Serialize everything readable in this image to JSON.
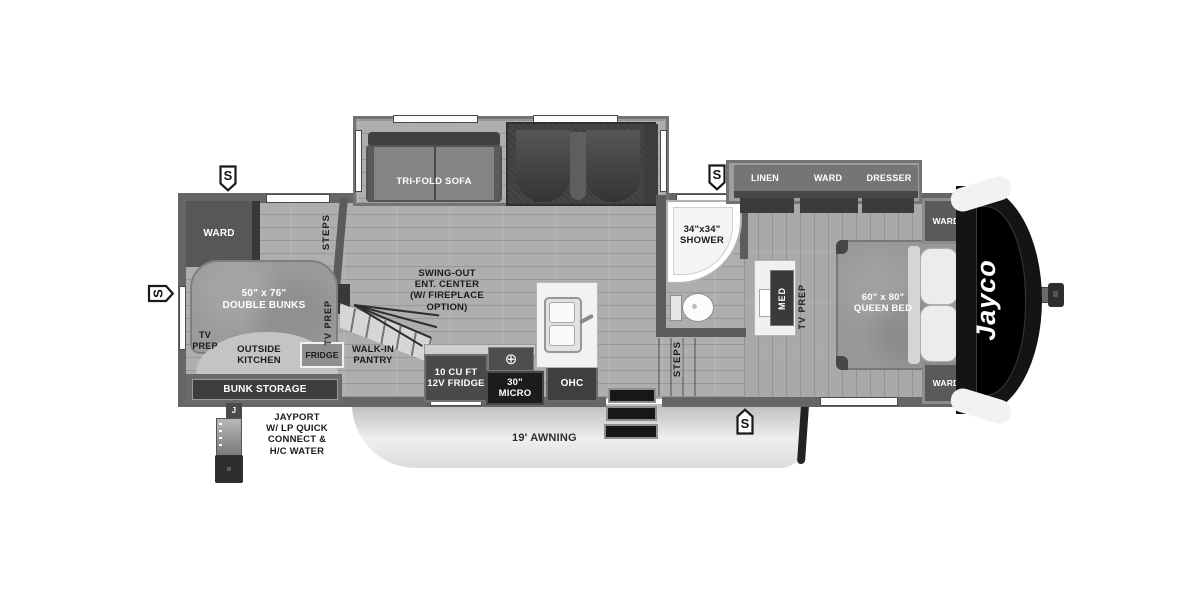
{
  "icons": {
    "speaker": "S",
    "burner": "⊕",
    "jayport_tab": "J"
  },
  "exterior": {
    "awning_label": "19' AWNING",
    "jayport_label": "JAYPORT\nW/ LP QUICK\nCONNECT &\nH/C WATER"
  },
  "bunk_room": {
    "wardrobe": "WARD",
    "steps": "STEPS",
    "double_bunks": "50\" x 76\"\nDOUBLE BUNKS",
    "tv_prep_left": "TV\nPREP",
    "outside_kitchen": "OUTSIDE\nKITCHEN",
    "fridge": "FRIDGE",
    "tv_prep_side": "TV PREP",
    "bunk_storage": "BUNK STORAGE"
  },
  "living": {
    "tri_fold_sofa": "TRI-FOLD SOFA",
    "ent_center": "SWING-OUT\nENT. CENTER\n(W/ FIREPLACE\nOPTION)",
    "walk_in_pantry": "WALK-IN\nPANTRY",
    "fridge_12v": "10 CU FT\n12V FRIDGE",
    "micro": "30\"\nMICRO",
    "ohc": "OHC"
  },
  "bath": {
    "shower": "34\"x34\"\nSHOWER",
    "steps": "STEPS"
  },
  "bedroom": {
    "linen": "LINEN",
    "ward_slide": "WARD",
    "dresser": "DRESSER",
    "med": "MED",
    "tv_prep": "TV PREP",
    "queen_bed": "60\" x 80\"\nQUEEN BED",
    "ward_front_top": "WARD",
    "ward_front_bottom": "WARD"
  },
  "brand": {
    "logo": "Jayco"
  }
}
